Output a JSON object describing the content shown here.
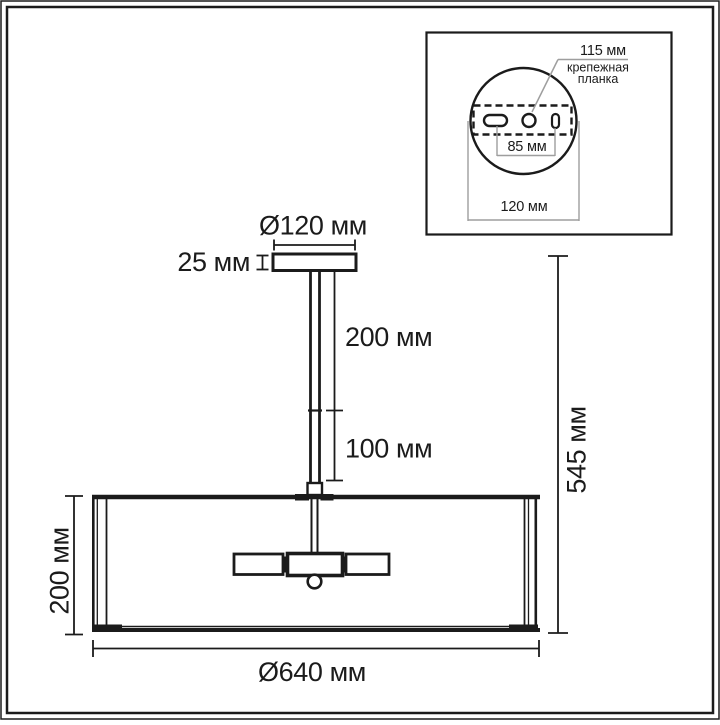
{
  "colors": {
    "ink": "#1b1b1b",
    "inset_guide": "#9e9e9e",
    "background": "#ffffff"
  },
  "main_view": {
    "canopy_diameter": "Ø120 мм",
    "canopy_height": "25 мм",
    "upper_rod_length": "200 мм",
    "lower_rod_length": "100 мм",
    "overall_height": "545 мм",
    "shade_height": "200 мм",
    "shade_diameter": "Ø640 мм"
  },
  "inset_view": {
    "bracket_length": "115 мм",
    "bracket_label_line1": "крепежная",
    "bracket_label_line2": "планка",
    "hole_spacing": "85 мм",
    "canopy_diameter": "120 мм"
  }
}
